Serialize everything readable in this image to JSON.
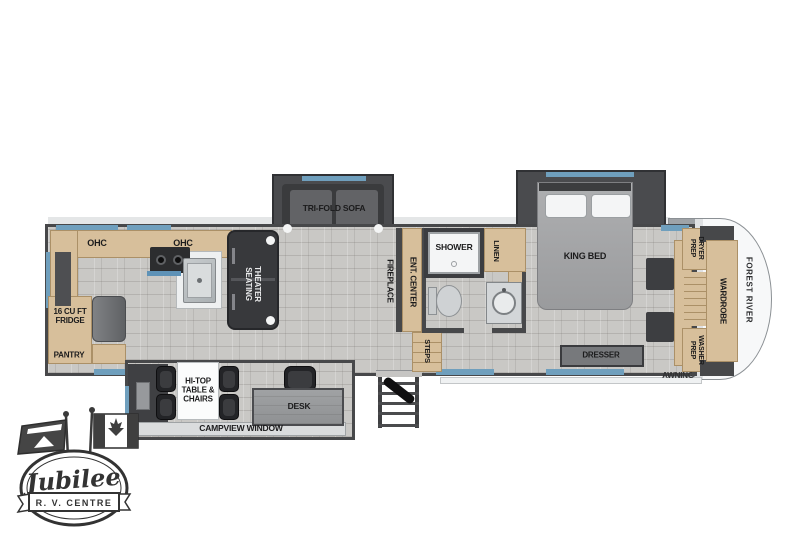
{
  "colors": {
    "floor": "#c9c8c5",
    "wall": "#47484a",
    "slide_wall": "#4a4b4e",
    "sofa_dark": "#3a3b3d",
    "furniture_dark": "#27282b",
    "cabinet": "#d7bf9b",
    "cabinet_edge": "#ab9067",
    "window_blue": "#6f9fbd",
    "steel": "#c2c6c8",
    "white_fixture": "#f4f5f6",
    "bed_gray": "#a4a5a7",
    "cap_silver": "#9fa3a7",
    "ink": "#1b1b1c",
    "logo_ink": "#3a3a3a"
  },
  "floorplan": {
    "brand": "FOREST RIVER",
    "awning": "AWNING",
    "kitchen": {
      "ohc_left": "OHC",
      "ohc_right": "OHC",
      "fridge": "16 CU FT\nFRIDGE",
      "pantry": "PANTRY"
    },
    "living": {
      "sofa": "TRI-FOLD SOFA",
      "theater": "THEATER\nSEATING",
      "fireplace": "FIREPLACE",
      "ent_center": "ENT. CENTER"
    },
    "bath": {
      "shower": "SHOWER",
      "linen": "LINEN",
      "steps": "STEPS"
    },
    "bedroom": {
      "bed": "KING BED",
      "dresser": "DRESSER"
    },
    "laundry": {
      "dryer": "DRYER\nPREP",
      "washer": "WASHER\nPREP",
      "wardrobe": "WARDROBE"
    },
    "den": {
      "table": "HI-TOP\nTABLE &\nCHAIRS",
      "desk": "DESK",
      "window": "CAMPVIEW WINDOW"
    }
  },
  "logo": {
    "name": "Jubilee",
    "subtitle": "R. V.  CENTRE"
  }
}
